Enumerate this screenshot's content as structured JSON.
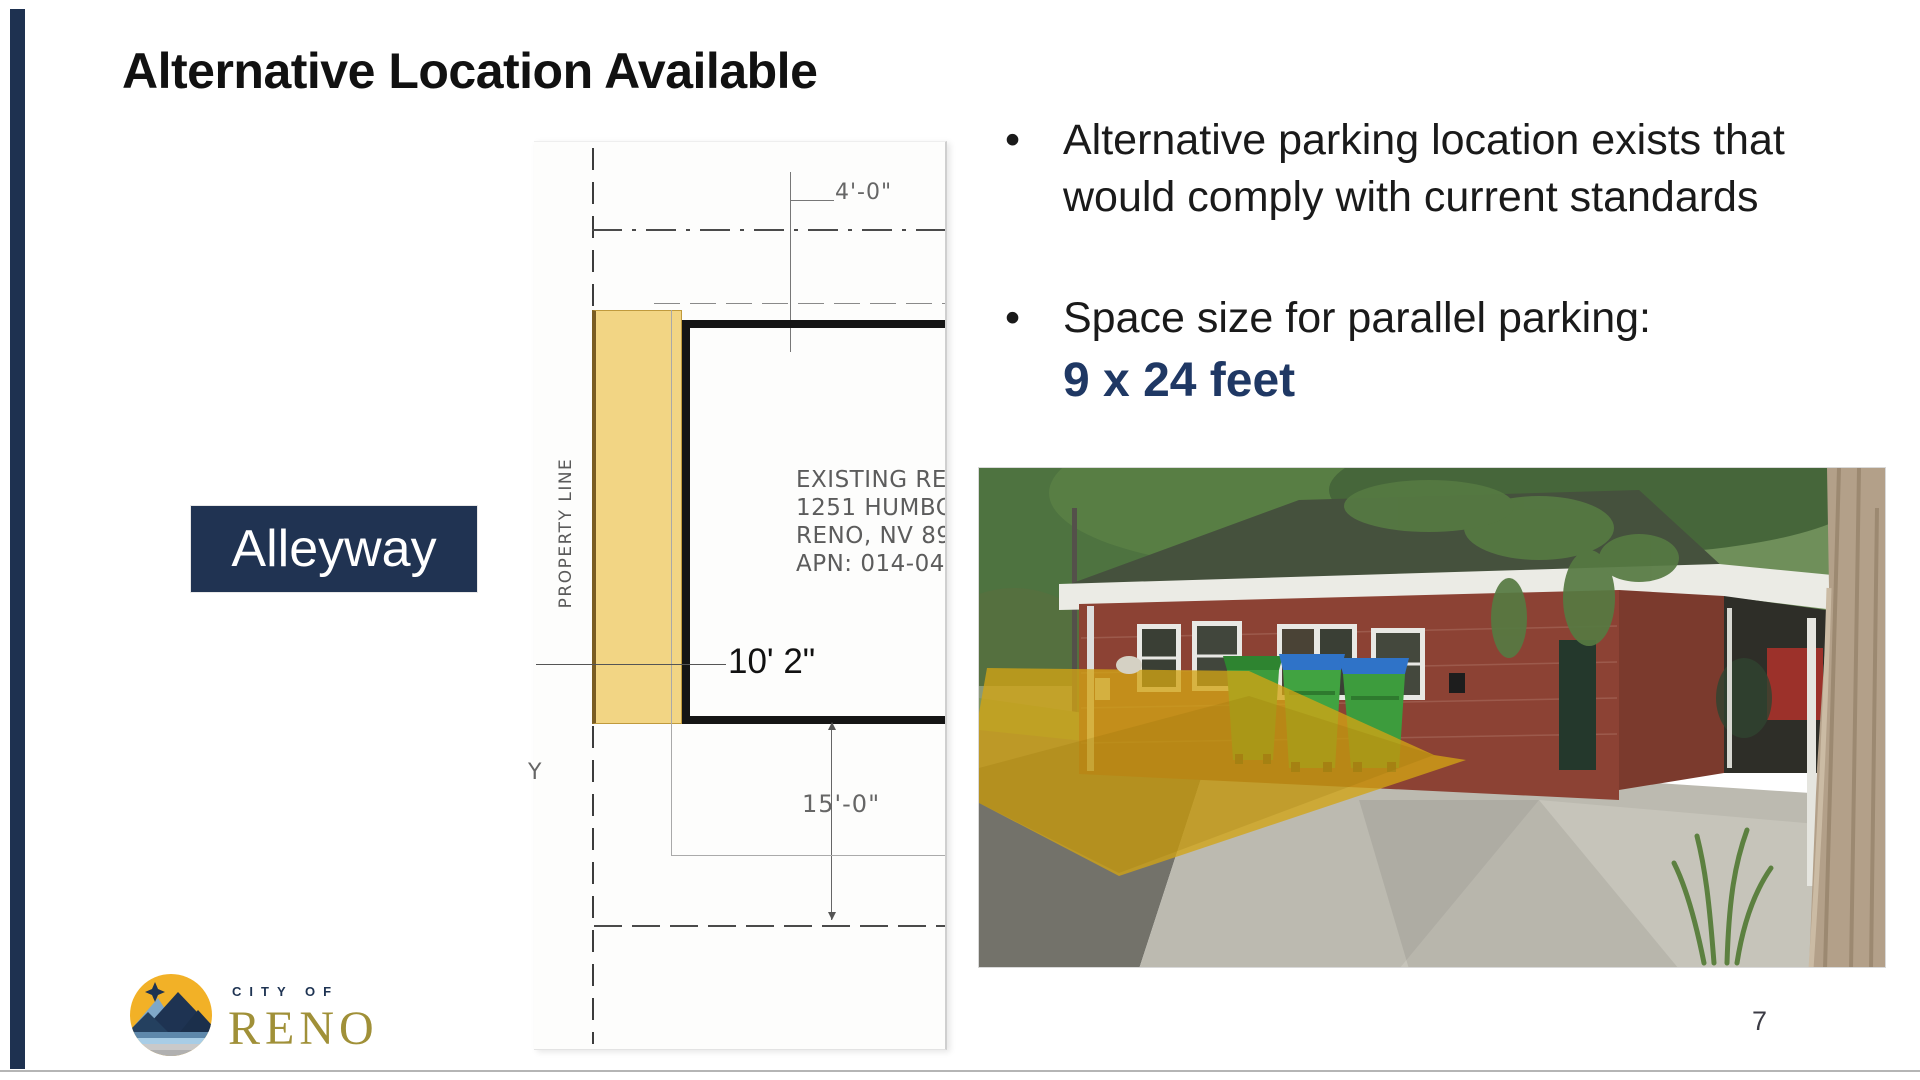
{
  "title": "Alternative Location Available",
  "bullets": {
    "marker": "•",
    "b1": {
      "line1": "Alternative parking location exists that",
      "line2": "would comply with current standards"
    },
    "b2": {
      "text": "Space size for parallel parking:",
      "highlight": "9 x 24 feet"
    }
  },
  "alleyway": {
    "label": "Alleyway"
  },
  "site_plan": {
    "dim_top": "4'-0\"",
    "property_line_label": "PROPERTY LINE",
    "address": [
      "EXISTING RE",
      "1251 HUMBOL",
      "RENO, NV 89",
      "APN: 014-046"
    ],
    "dim_width": "10' 2\"",
    "dim_bottom": "15'-0\"",
    "axis_label": "Y"
  },
  "footer": {
    "page_number": "7",
    "logo_city_of": "C I T Y   O F",
    "logo_reno": "RENO"
  },
  "colors": {
    "accent_navy": "#203352",
    "highlight_navy": "#1F3864",
    "plan_highlight_yellow": "#F2D584",
    "photo_overlay_gold": "#D2A414",
    "logo_circle_gold": "#F2B127",
    "logo_reno_gold": "#A09038"
  }
}
